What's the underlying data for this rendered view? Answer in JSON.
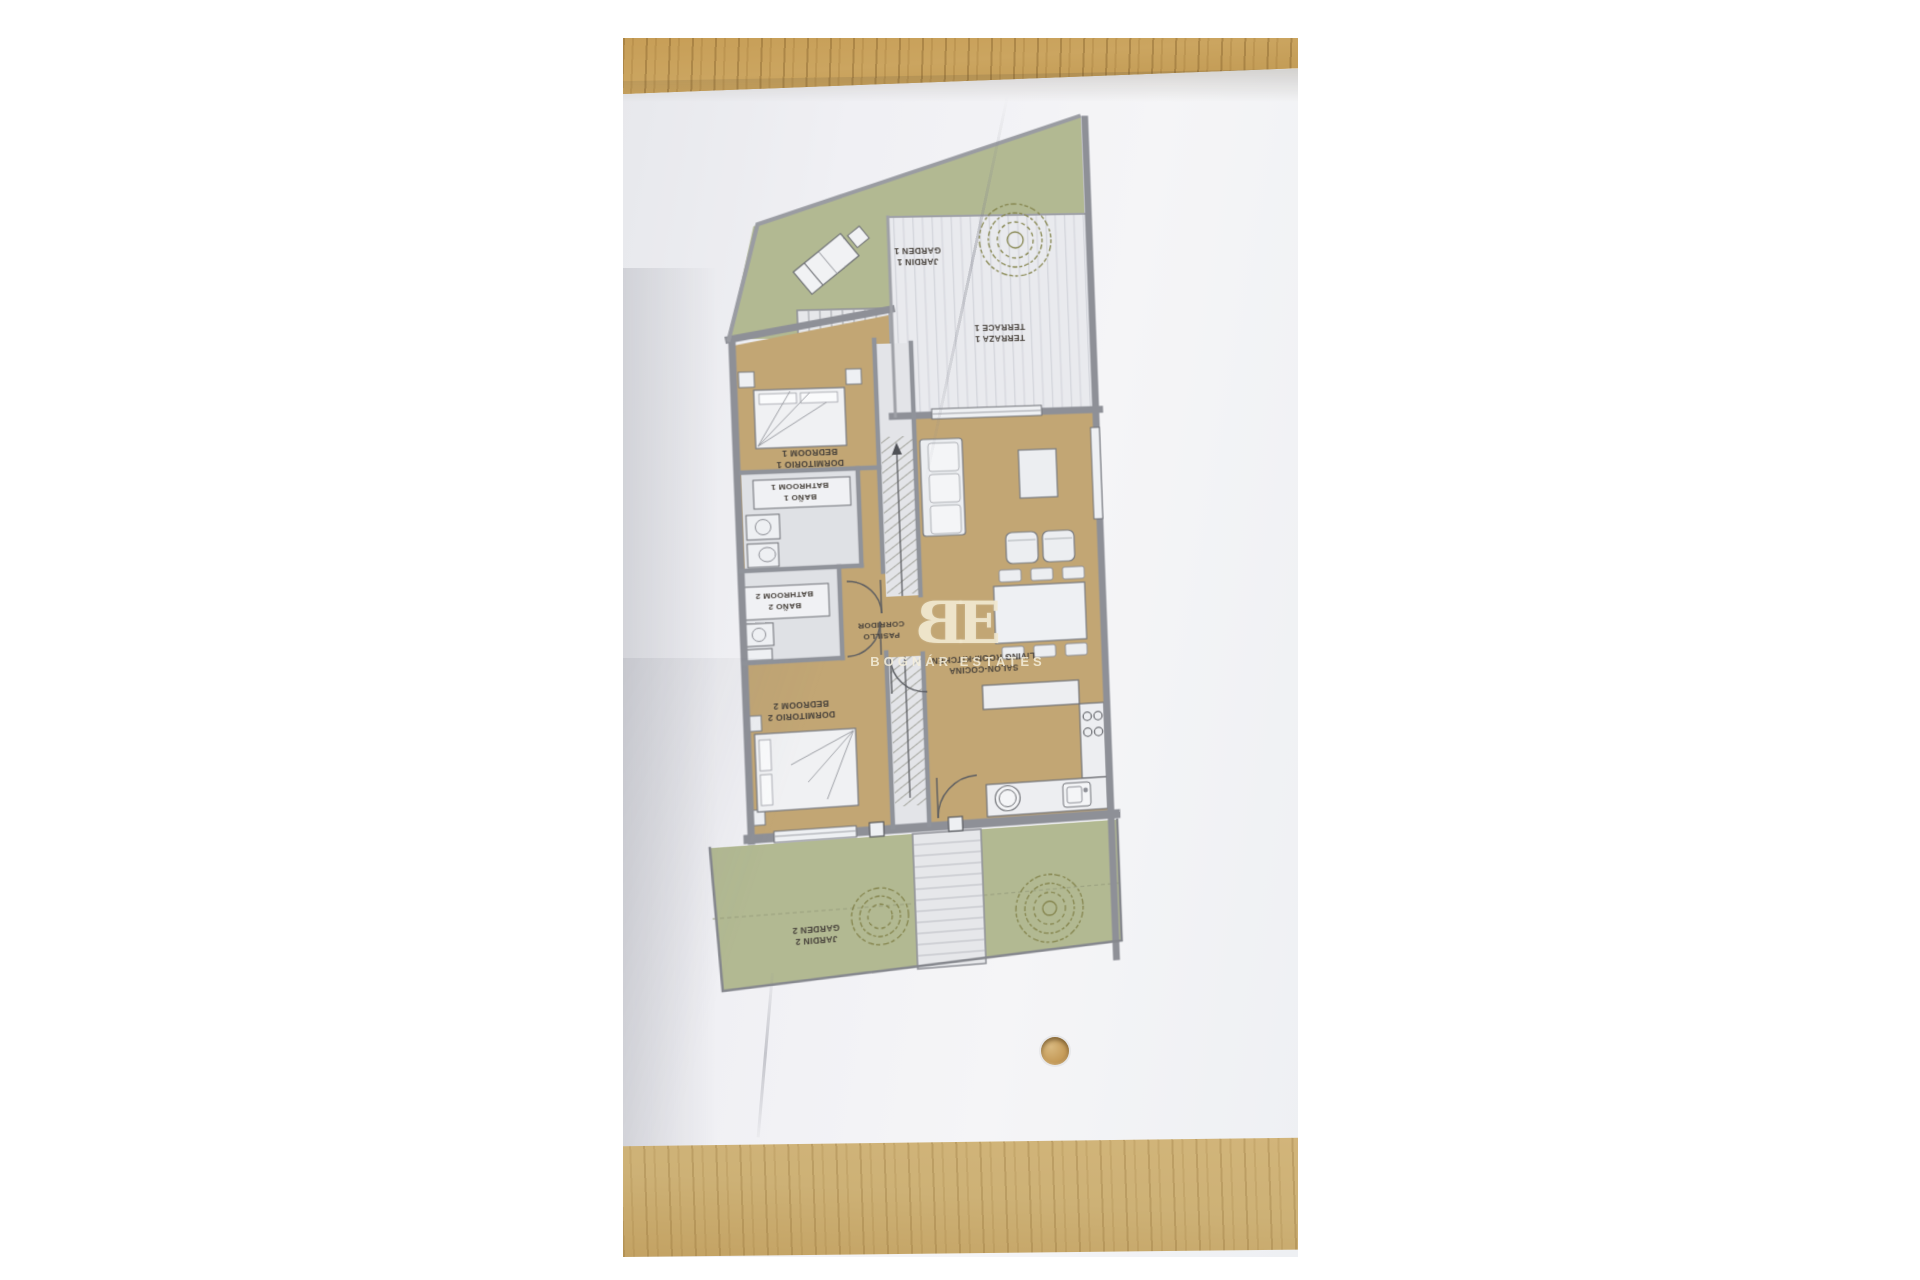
{
  "scene": {
    "description": "Printed apartment floor plan lying upside-down on a wooden desk"
  },
  "rooms": {
    "garden1": {
      "es": "JARDIN 1",
      "en": "GARDEN 1"
    },
    "terrace1": {
      "es": "TERRAZA 1",
      "en": "TERRACE 1"
    },
    "bedroom1": {
      "es": "DORMITORIO 1",
      "en": "BEDROOM 1"
    },
    "bathroom1": {
      "es": "BAÑO 1",
      "en": "BATHROOM 1"
    },
    "bathroom2": {
      "es": "BAÑO 2",
      "en": "BATHROOM 2"
    },
    "corridor": {
      "es": "PASILLO",
      "en": "CORRIDOR"
    },
    "bedroom2": {
      "es": "DORMITORIO 2",
      "en": "BEDROOM 2"
    },
    "living": {
      "es": "SALON-COCINA",
      "en": "LIVING ROOM-KITCHEN"
    },
    "garden2": {
      "es": "JARDIN 2",
      "en": "GARDEN 2"
    }
  },
  "watermark": {
    "monogram_left": "B",
    "monogram_right": "E",
    "name": "BOGNÁR ESTATES"
  },
  "colors": {
    "wood": "#c79e57",
    "wood_light": "#d0b377",
    "paper": "#f1f1f4",
    "garden_green": "#b2b992",
    "floor_tan": "#c2a674",
    "terrace_deck": "#e9eaee",
    "wall_gray": "#8e9097",
    "hatch": "#70715f",
    "label_text": "#46403a",
    "watermark_cream": "#efe6cd",
    "bush_outline": "#85854e"
  }
}
